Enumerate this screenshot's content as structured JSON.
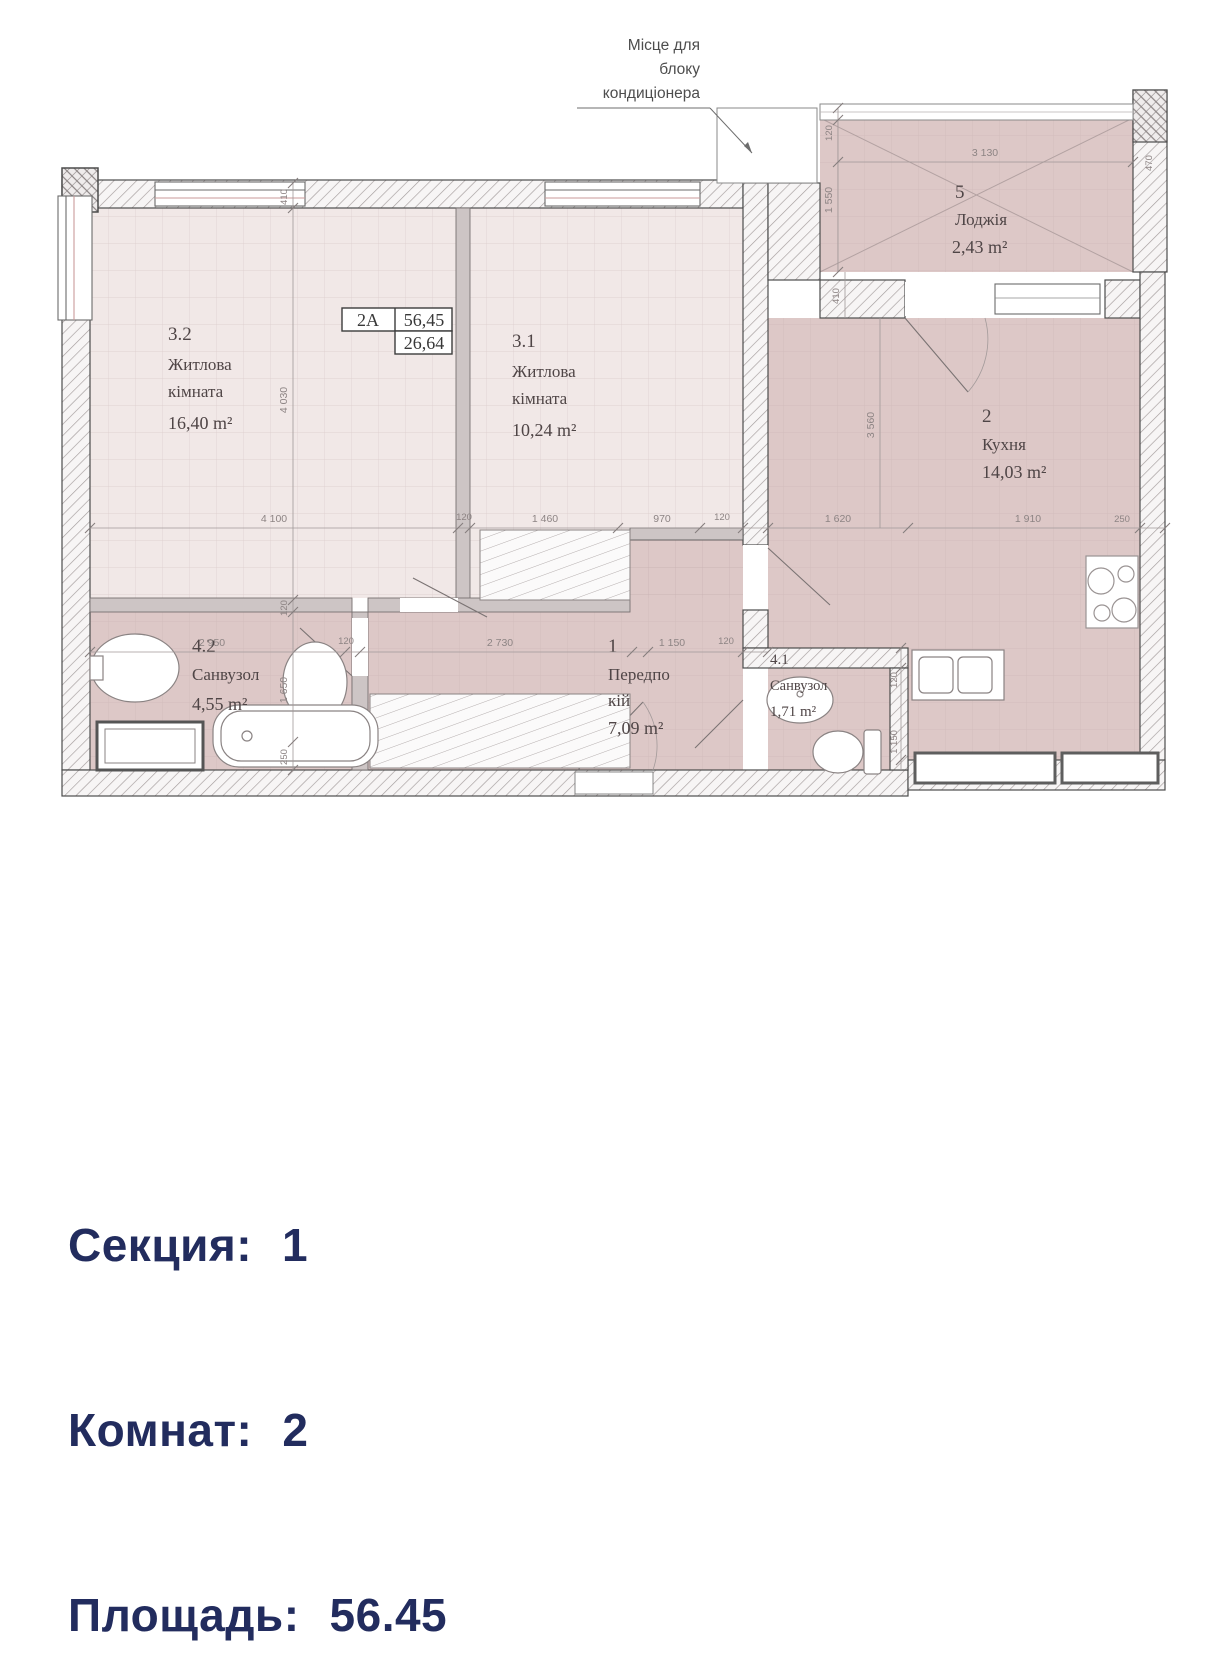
{
  "colors": {
    "floor_light": "#f1e8e7",
    "floor_dark": "#ddc8c7",
    "wall_line": "#4c4c4c",
    "dim_text": "#8d8484",
    "info_text": "#222c5e"
  },
  "plan": {
    "ac_note": {
      "line1": "Місце для",
      "line2": "блоку",
      "line3": "кондиціонера"
    },
    "unit_label": {
      "code": "2А",
      "area_total": "56,45",
      "area_living": "26,64"
    },
    "rooms": [
      {
        "id": "3.2",
        "l1": "Житлова",
        "l2": "кімната",
        "area": "16,40 m²"
      },
      {
        "id": "3.1",
        "l1": "Житлова",
        "l2": "кімната",
        "area": "10,24 m²"
      },
      {
        "id": "2",
        "l1": "Кухня",
        "l2": "",
        "area": "14,03 m²"
      },
      {
        "id": "5",
        "l1": "Лоджія",
        "l2": "",
        "area": "2,43 m²"
      },
      {
        "id": "4.2",
        "l1": "Санвузол",
        "l2": "",
        "area": "4,55 m²"
      },
      {
        "id": "1",
        "l1": "Передпо",
        "l2": "кій",
        "area": "7,09 m²"
      },
      {
        "id": "4.1",
        "l1": "Санвузол",
        "l2": "",
        "area": "1,71 m²"
      }
    ],
    "dims_main": [
      "4 100",
      "120",
      "1 460",
      "970",
      "120",
      "1 620",
      "1 910",
      "250"
    ],
    "dims_hall": [
      "2 950",
      "120",
      "2 730",
      "1 150",
      "120"
    ],
    "dims_left_v": [
      "410",
      "4 030",
      "120",
      "1 650",
      "250"
    ],
    "dims_kitchen_v": "3 560",
    "dims_41_v": [
      "120",
      "1 150"
    ],
    "dims_loggia": {
      "wall": "120",
      "depth": "1 550",
      "width": "3 130",
      "side": "470",
      "below": "410"
    }
  },
  "info": {
    "rows": [
      {
        "label": "Секция:",
        "value": "1"
      },
      {
        "label": "Комнат:",
        "value": "2"
      },
      {
        "label": "Площадь:",
        "value": "56.45"
      }
    ]
  }
}
